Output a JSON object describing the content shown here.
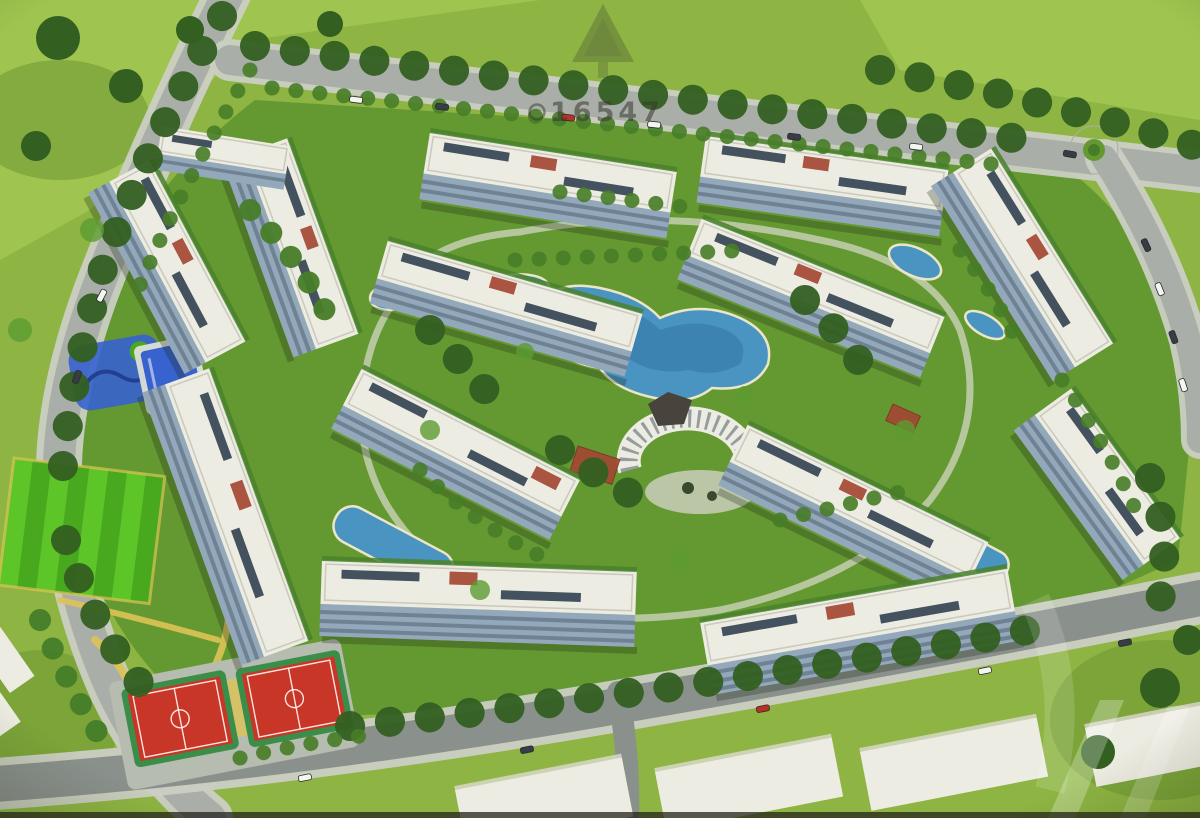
{
  "image": {
    "type": "aerial-architectural-render",
    "description": "Aerial 3D rendering of a residential apartment compound: white-roofed apartment blocks arranged in a ring around a landscaped central park with blue lagoon pools and a curved clubhouse, perimeter roads with cars and tree rows, a striped lawn, kids pool and playground, and two red basketball courts at the lower left",
    "watermark": {
      "text": "16547"
    },
    "palette": {
      "grass": "#8fb24a",
      "grassLight": "#9fc257",
      "grassDark": "#6f9638",
      "parkGreen": "#679739",
      "treeDark": "#375f26",
      "treeMid": "#4a7c2e",
      "treeLight": "#5f9a38",
      "road": "#a8ada8",
      "roadDark": "#8a908c",
      "sidewalk": "#c9ccc2",
      "roofWhite": "#eae9e0",
      "roofShade": "#d8d7cc",
      "parapet": "#c2c1b4",
      "facadeBlue": "#93a7b7",
      "facadeDark": "#5d6f7e",
      "panelDark": "#2f3e4c",
      "waterBlue": "#4f93bd",
      "waterDeep": "#33719d",
      "poolBlue": "#3c63c6",
      "courtRed": "#bf3a2b",
      "courtGreen": "#3f8c4d",
      "fieldGreen": "#63c132",
      "fieldGreenDark": "#4da627",
      "pathYellow": "#d8c15c",
      "pergolaRed": "#9e4a37",
      "plaza": "#c9cbbb",
      "carWhite": "#f2f2ee",
      "carDark": "#3a3f46",
      "carRed": "#b23426"
    }
  }
}
